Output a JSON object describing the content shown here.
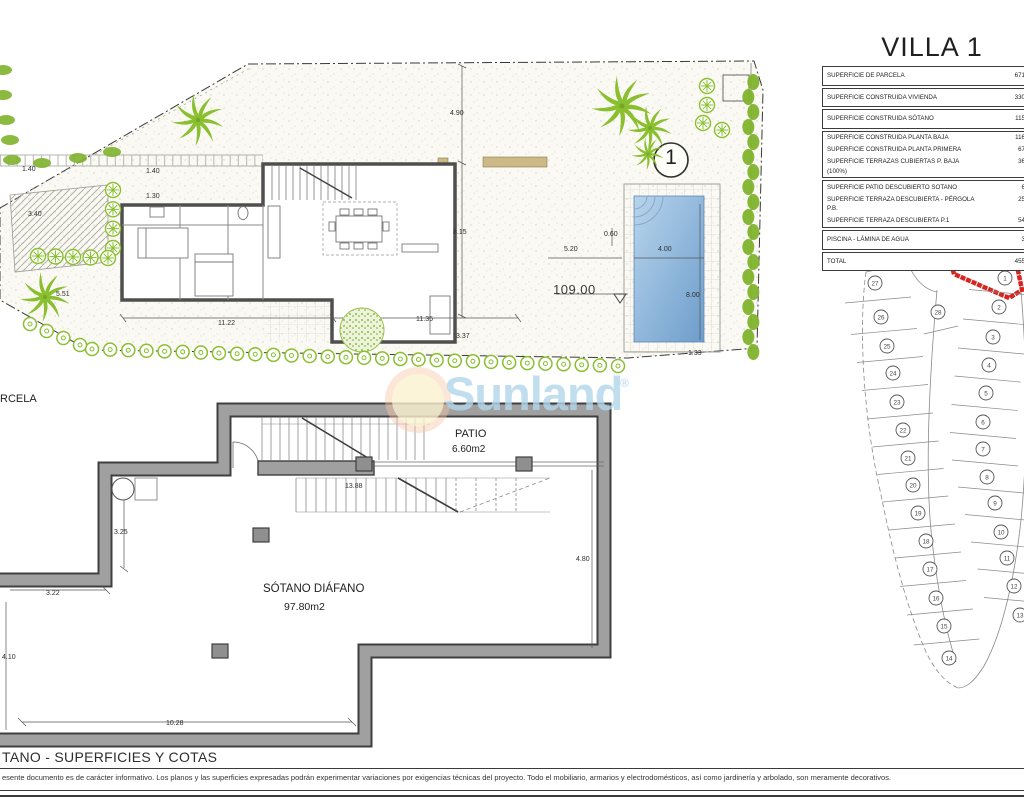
{
  "title": "VILLA 1",
  "surface_table": {
    "groups": [
      [
        {
          "label": "SUPERFICIE DE PARCELA",
          "value": "671"
        }
      ],
      [
        {
          "label": "SUPERFICIE CONSTRUIDA VIVIENDA",
          "value": "330"
        }
      ],
      [
        {
          "label": "SUPERFICIE CONSTRUIDA SÓTANO",
          "value": "115"
        }
      ],
      [
        {
          "label": "SUPERFICIE CONSTRUIDA PLANTA BAJA",
          "value": "116"
        },
        {
          "label": "SUPERFICIE CONSTRUIDA PLANTA PRIMERA",
          "value": "67"
        },
        {
          "label": "SUPERFICIE TERRAZAS CUBIERTAS P. BAJA (100%)",
          "value": "36"
        }
      ],
      [
        {
          "label": "SUPERFICIE PATIO DESCUBIERTO SOTANO",
          "value": "6"
        },
        {
          "label": "SUPERFICIE TERRAZA DESCUBIERTA - PÉRGOLA P.B.",
          "value": "25"
        },
        {
          "label": "SUPERFICIE TERRAZA DESCUBIERTA P.1",
          "value": "54"
        }
      ],
      [
        {
          "label": "PISCINA - LÁMINA DE AGUA",
          "value": "3"
        }
      ],
      [
        {
          "label": "TOTAL",
          "value": "455"
        }
      ]
    ]
  },
  "site_plan": {
    "marker": "1",
    "parcel_label_fragment": "RCELA",
    "dimensions": [
      {
        "text": "4.90",
        "x": 450,
        "y": 110
      },
      {
        "text": "1.40",
        "x": 22,
        "y": 166
      },
      {
        "text": "1.40",
        "x": 146,
        "y": 168
      },
      {
        "text": "1.30",
        "x": 146,
        "y": 193
      },
      {
        "text": "3.40",
        "x": 28,
        "y": 211
      },
      {
        "text": "5.51",
        "x": 56,
        "y": 291
      },
      {
        "text": "8.15",
        "x": 453,
        "y": 229
      },
      {
        "text": "11.22",
        "x": 218,
        "y": 320
      },
      {
        "text": "11.35",
        "x": 416,
        "y": 316
      },
      {
        "text": "3.37",
        "x": 456,
        "y": 333
      },
      {
        "text": "5.20",
        "x": 564,
        "y": 246
      },
      {
        "text": "0.60",
        "x": 604,
        "y": 231
      },
      {
        "text": "4.00",
        "x": 658,
        "y": 246
      },
      {
        "text": "8.00",
        "x": 686,
        "y": 292
      },
      {
        "text": "1.33",
        "x": 688,
        "y": 350
      },
      {
        "text": "109.00",
        "x": 553,
        "y": 282,
        "size": "lg"
      }
    ]
  },
  "basement_plan": {
    "room_label": "SÓTANO DIÁFANO",
    "room_area": "97.80m2",
    "patio_label": "PATIO",
    "patio_area": "6.60m2",
    "dimensions": [
      {
        "text": "13.88",
        "x": 345,
        "y": 483
      },
      {
        "text": "3.25",
        "x": 114,
        "y": 529
      },
      {
        "text": "3.22",
        "x": 46,
        "y": 590
      },
      {
        "text": "4.10",
        "x": 2,
        "y": 654
      },
      {
        "text": "10.28",
        "x": 166,
        "y": 720
      },
      {
        "text": "4.80",
        "x": 576,
        "y": 556
      }
    ]
  },
  "plot_map": {
    "highlighted_plot": "1",
    "highlight_color": "#d9251f",
    "plots": [
      {
        "n": "27",
        "x": 875,
        "y": 283,
        "col": "L"
      },
      {
        "n": "26",
        "x": 881,
        "y": 317,
        "col": "L"
      },
      {
        "n": "25",
        "x": 887,
        "y": 346,
        "col": "L"
      },
      {
        "n": "24",
        "x": 893,
        "y": 373,
        "col": "L"
      },
      {
        "n": "23",
        "x": 897,
        "y": 402,
        "col": "L"
      },
      {
        "n": "22",
        "x": 903,
        "y": 430,
        "col": "L"
      },
      {
        "n": "21",
        "x": 908,
        "y": 458,
        "col": "L"
      },
      {
        "n": "20",
        "x": 913,
        "y": 485,
        "col": "L"
      },
      {
        "n": "19",
        "x": 918,
        "y": 513,
        "col": "L"
      },
      {
        "n": "18",
        "x": 926,
        "y": 541,
        "col": "L"
      },
      {
        "n": "17",
        "x": 930,
        "y": 569,
        "col": "L"
      },
      {
        "n": "16",
        "x": 936,
        "y": 598,
        "col": "L"
      },
      {
        "n": "15",
        "x": 944,
        "y": 626,
        "col": "L"
      },
      {
        "n": "14",
        "x": 949,
        "y": 658,
        "col": "L"
      },
      {
        "n": "28",
        "x": 938,
        "y": 312,
        "col": "C"
      },
      {
        "n": "1",
        "x": 1005,
        "y": 278,
        "col": "R"
      },
      {
        "n": "2",
        "x": 999,
        "y": 307,
        "col": "R"
      },
      {
        "n": "3",
        "x": 993,
        "y": 337,
        "col": "R"
      },
      {
        "n": "4",
        "x": 989,
        "y": 365,
        "col": "R"
      },
      {
        "n": "5",
        "x": 986,
        "y": 393,
        "col": "R"
      },
      {
        "n": "6",
        "x": 983,
        "y": 422,
        "col": "R"
      },
      {
        "n": "7",
        "x": 983,
        "y": 449,
        "col": "R"
      },
      {
        "n": "8",
        "x": 987,
        "y": 477,
        "col": "R"
      },
      {
        "n": "9",
        "x": 995,
        "y": 503,
        "col": "R"
      },
      {
        "n": "10",
        "x": 1001,
        "y": 532,
        "col": "R"
      },
      {
        "n": "11",
        "x": 1007,
        "y": 558,
        "col": "R"
      },
      {
        "n": "12",
        "x": 1014,
        "y": 586,
        "col": "R"
      },
      {
        "n": "13",
        "x": 1020,
        "y": 615,
        "col": "R"
      }
    ]
  },
  "watermark": {
    "text": "Sunland",
    "registered": "®"
  },
  "footer": {
    "section_title": "TANO - SUPERFICIES Y COTAS",
    "disclaimer": "esente documento es de carácter informativo. Los planos y las superficies expresadas podrán experimentar variaciones por exigencias técnicas del proyecto. Todo el mobiliario, armarios y electrodomésticos, así como jardinería y arbolado, son meramente decorativos."
  },
  "colors": {
    "vegetation": "#8abf2f",
    "pool_water": "#7aa6d2",
    "terrace_tan": "#cdb987",
    "wall_gray": "#a0a0a0",
    "highlight_red": "#d9251f",
    "watermark_blue": "#b2d7ec"
  }
}
